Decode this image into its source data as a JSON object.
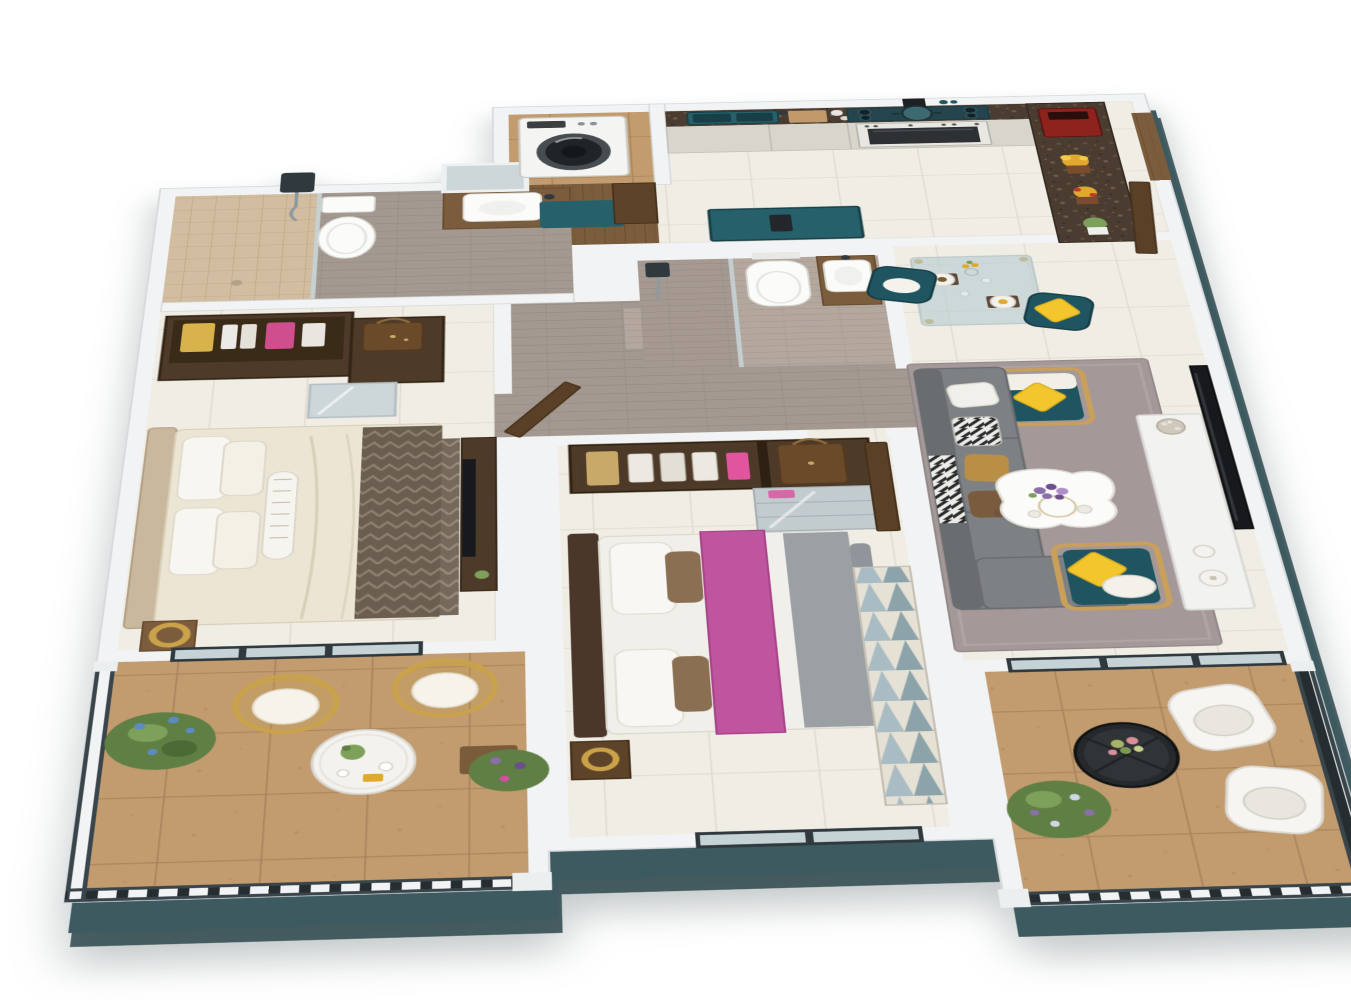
{
  "meta": {
    "title": "Isometric 3D floor plan render — two-bedroom apartment with two balconies",
    "view": "top-down axonometric architectural rendering, no text labels, transparent background"
  },
  "palette": {
    "wall": "#f2f3f4",
    "wall_edge": "#d2d7d9",
    "plinth": "#3c5a5f",
    "plinth_dark": "#2d474c",
    "floor": "#f0ede5",
    "grout": "#e1dcd1",
    "tan": "#c29c6f",
    "tan_line": "#a9845c",
    "wood": "#7b5c3c",
    "wood_line": "#694d30",
    "wood_dark": "#4e3a28",
    "wood_door": "#5a4026",
    "granite": "#4a3c31",
    "teal": "#1f5560",
    "teal_sink": "#26606a",
    "teal_deep": "#173f47",
    "hob": "#24454d",
    "sofa": "#7e8184",
    "sofa_dark": "#6a6d70",
    "rug_mauve": "#a49898",
    "rug_tri_a": "#a9bcc3",
    "rug_tri_b": "#e6e1d5",
    "rug_tri_c": "#7d98a2",
    "bed_cream": "#ece5d4",
    "throw_dark": "#6a5e50",
    "throw_line": "#8c7f6e",
    "magenta": "#c0559f",
    "yellow": "#f2c62c",
    "gold": "#c9a24a",
    "rail": "#262d30",
    "rail_edge": "#39454a",
    "frame": "#303a3e",
    "glass": "#c5d3d6",
    "white_fix": "#fbfbf9",
    "fix_edge": "#d8d8d2",
    "gray_tile": "#b3a79e",
    "gray_tile_dark": "#a2968d",
    "planks": "#a39990",
    "planks_line": "#918881",
    "beige_tile": "#d2bda1",
    "tv": "#17191c",
    "green": "#5f7f44",
    "green_light": "#7da05a",
    "flower_purple": "#8b6fa8",
    "flower_blue": "#5d8bbf",
    "flower_magenta": "#d0519c",
    "flower_yellow": "#e0a92e",
    "red_appliance": "#8e221d",
    "mirror": "#cdd7da",
    "cabinet": "#d8d5cc"
  },
  "rooms": [
    {
      "id": "kitchen",
      "name": "Open kitchen",
      "furniture": [
        "granite countertop",
        "teal double sink",
        "5-burner gas hob with pot",
        "wall hood",
        "built-in oven",
        "white cabinets",
        "granite bar counter",
        "red coffee machine",
        "yellow flower pots",
        "green plant",
        "teal breakfast desk"
      ]
    },
    {
      "id": "laundry",
      "name": "Laundry / utility",
      "furniture": [
        "washing machine",
        "teal mat",
        "wooden cupboard"
      ]
    },
    {
      "id": "entry",
      "name": "Entrance",
      "furniture": [
        "open wooden door",
        "wood threshold"
      ]
    },
    {
      "id": "master-bathroom",
      "name": "Master bathroom",
      "furniture": [
        "walk-in shower with glass screen",
        "chrome shower set",
        "toilet",
        "wood vanity with white basin",
        "leaning mirror"
      ]
    },
    {
      "id": "walk-in-closet",
      "name": "Walk-in closet",
      "furniture": [
        "open wardrobe",
        "yellow handbag",
        "white shoes",
        "pink handbag",
        "brown designer bag",
        "mirrored cabinet"
      ]
    },
    {
      "id": "master-bedroom",
      "name": "Master bedroom",
      "furniture": [
        "king bed with cream duvet",
        "white pillows",
        "striped bolster",
        "patterned dark throw",
        "gold ring lamp",
        "wood media console",
        "flat TV"
      ]
    },
    {
      "id": "master-balcony",
      "name": "Master balcony",
      "furniture": [
        "two gold wire chairs with white cushions",
        "round bistro table",
        "green plant with blue flowers",
        "purple flower pot",
        "dark metal railing"
      ]
    },
    {
      "id": "second-bathroom",
      "name": "Second bathroom",
      "furniture": [
        "shower with glass screen",
        "wall-hung toilet",
        "wood vanity with vessel basin"
      ]
    },
    {
      "id": "hallway",
      "name": "Hallway",
      "furniture": [
        "gray plank flooring",
        "open wooden doors"
      ]
    },
    {
      "id": "second-bedroom",
      "name": "Second bedroom",
      "furniture": [
        "open wardrobe with heels and handbags",
        "brown monogram bag",
        "mirrored dresser",
        "double bed with magenta runner",
        "gray throw",
        "gold lamp",
        "triangle-pattern rug",
        "picture window"
      ]
    },
    {
      "id": "living-dining",
      "name": "Living / dining room",
      "furniture": [
        "glass dining table with gold legs",
        "two teal dining chairs",
        "place settings",
        "gray fabric sofa",
        "zebra pillow",
        "gold pillow",
        "teal-oak armchair north",
        "teal-oak lounge chair south",
        "yellow cushions",
        "organic white coffee table",
        "purple bouquet",
        "mauve rug",
        "white media cabinet",
        "wall TV",
        "white vases",
        "silver flower ball",
        "sliding glass doors"
      ]
    },
    {
      "id": "living-balcony",
      "name": "Living balcony",
      "furniture": [
        "two white tub chairs",
        "black drum side table",
        "flower arrangement",
        "potted plant",
        "dark metal railing"
      ]
    }
  ]
}
